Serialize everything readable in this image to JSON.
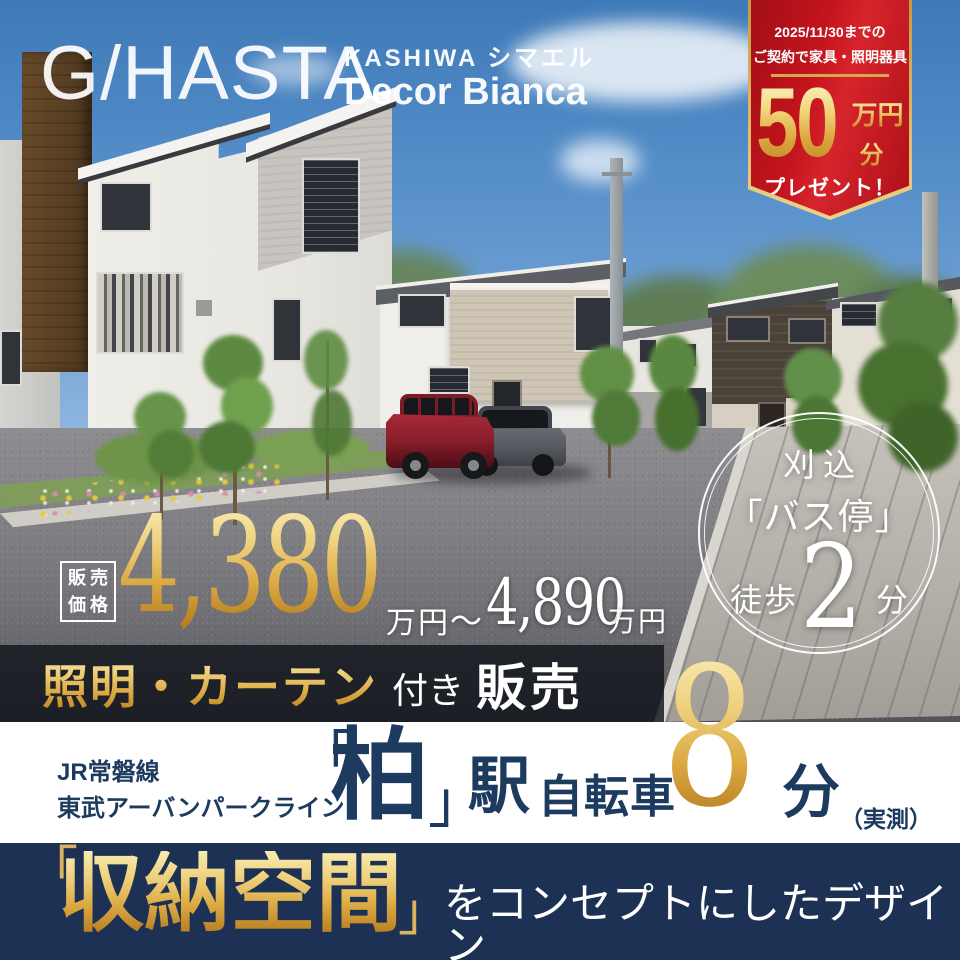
{
  "logo": {
    "brand": "G/HASTA.",
    "series": "KASHIWA シマエル",
    "model": "Decor Bianca"
  },
  "campaign": {
    "period": "2025/11/30までの",
    "condition": "ご契約で家具・照明器具",
    "amount": "50",
    "amount_unit1": "万円",
    "amount_unit2": "分",
    "gift": "プレゼント！"
  },
  "bus_badge": {
    "area": "刈込",
    "stop": "「バス停」",
    "walk_label": "徒歩",
    "walk_minutes": "2",
    "walk_unit": "分"
  },
  "price": {
    "label_line1": "販売",
    "label_line2": "価格",
    "min": "4,380",
    "min_unit": "万円",
    "tilde": "〜",
    "max": "4,890",
    "max_unit": "万円"
  },
  "included": {
    "gold_items": "照明・カーテン",
    "suffix": "付き",
    "sale": "販売"
  },
  "access": {
    "line1": "JR常磐線",
    "line2": "東武アーバンパークライン",
    "bracket_open": "「",
    "station": "柏",
    "bracket_close": "」",
    "station_suffix": "駅",
    "mode": "自転車",
    "minutes": "8",
    "minutes_unit": "分",
    "note": "（実測）"
  },
  "concept": {
    "bracket_open": "「",
    "keyword": "収納空間",
    "bracket_close": "」",
    "tail": "をコンセプトにしたデザイン"
  },
  "colors": {
    "navy": "#1c3153",
    "gold": "#d8a84a",
    "red": "#c4141d",
    "sky": "#5b93cc",
    "white": "#ffffff"
  }
}
